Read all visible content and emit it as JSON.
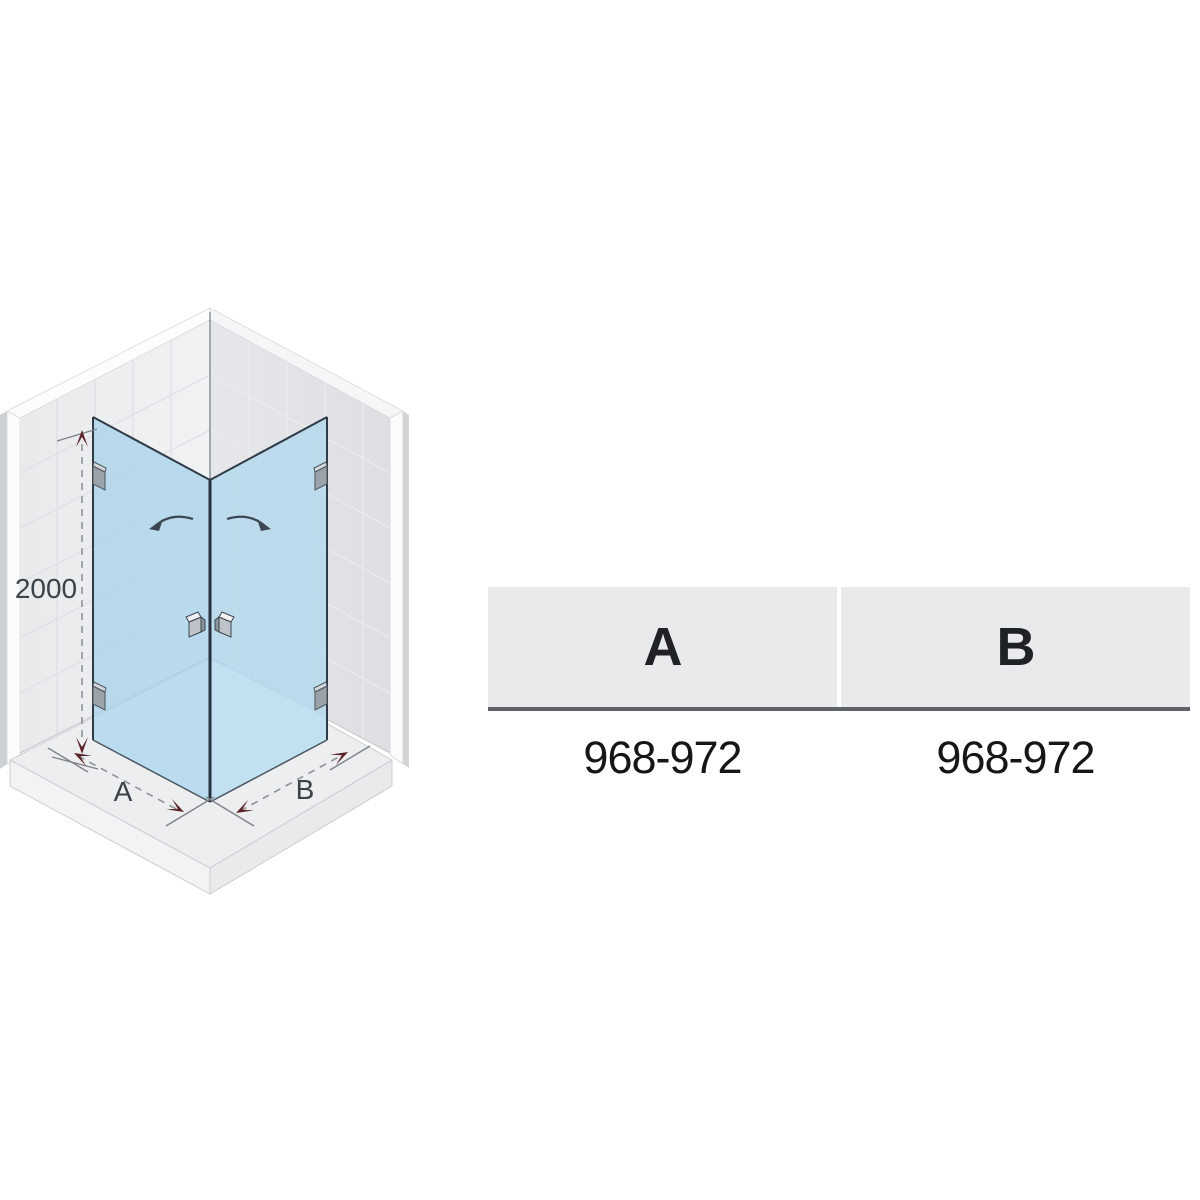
{
  "diagram": {
    "height_label": "2000",
    "width_label_a": "A",
    "width_label_b": "B",
    "colors": {
      "glass": "#a9d4ea",
      "glass_edge": "#2f3c48",
      "wall_left": "#edeff1",
      "wall_right": "#e1e3e6",
      "floor": "#eceef0",
      "dimension_arrow": "#5a2327",
      "dimension_line": "#8e9499",
      "label_text": "#3a424a"
    }
  },
  "table": {
    "columns": [
      {
        "header": "A",
        "value": "968-972"
      },
      {
        "header": "B",
        "value": "968-972"
      }
    ]
  }
}
